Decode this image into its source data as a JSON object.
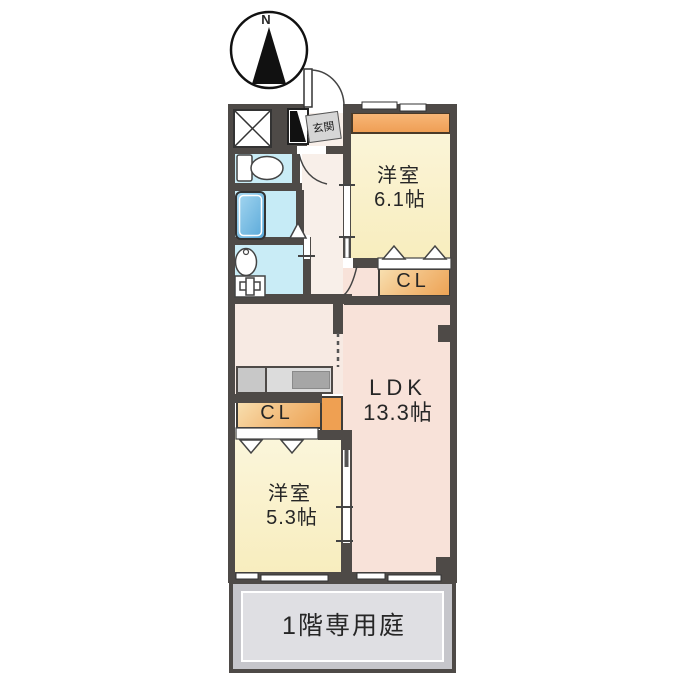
{
  "compass": {
    "label": "N"
  },
  "rooms": {
    "genkan": {
      "label": "玄関"
    },
    "room61": {
      "name_label": "洋室",
      "size_label": "6.1帖"
    },
    "cl_right": {
      "label": "CL"
    },
    "ldk": {
      "name_label": "LDK",
      "size_label": "13.3帖"
    },
    "cl_left": {
      "label": "CL"
    },
    "room53": {
      "name_label": "洋室",
      "size_label": "5.3帖"
    },
    "garden": {
      "label": "1階専用庭"
    }
  },
  "colors": {
    "wall": "#4E4A47",
    "room_yellow": "#FAF3CE",
    "ldk_pink": "#F8E2D9",
    "hall_pink": "#F8EFE9",
    "kitchen_pink": "#F7EAE3",
    "wet_blue": "#C9ECF6",
    "tub_blue": "#6FB8E2",
    "closet_orange": "#EDA355",
    "counter_gray": "#DCDCDC",
    "garden_gray": "#DFDFE3"
  }
}
